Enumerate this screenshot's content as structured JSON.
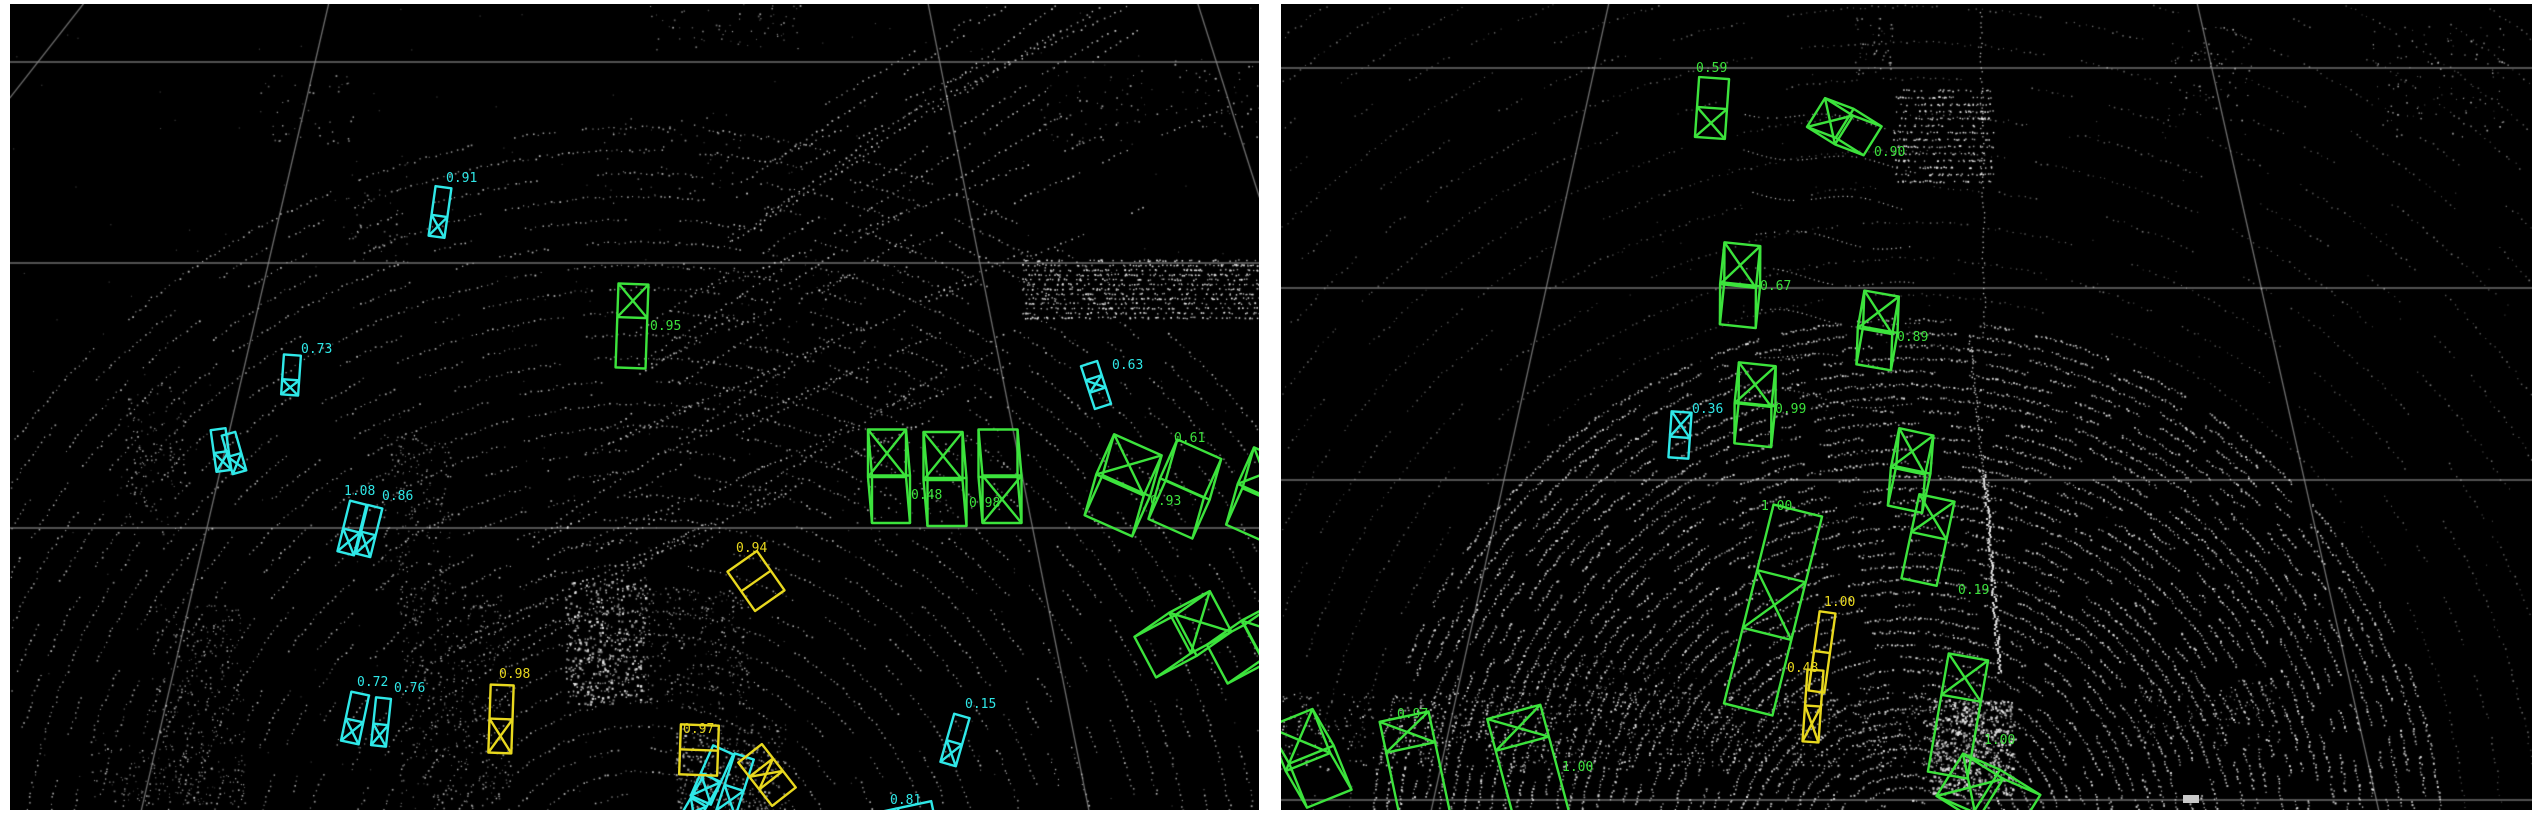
{
  "view": {
    "left_view_name": "lidar-bev-view-left",
    "right_view_name": "lidar-bev-view-right"
  },
  "colors": {
    "vehicle_green": "#3ce33c",
    "pedestrian_cyan": "#2fe8e8",
    "cyclist_yellow": "#e8d81e",
    "grid_line": "#8a8a8a",
    "point_cloud": "#efefef",
    "panel_background": "#000000",
    "page_background": "#ffffff",
    "ego_marker": "#c9c9c9"
  },
  "panels": [
    {
      "id": "left",
      "detections": [
        {
          "color": "cyan",
          "score": "0.91",
          "cx": 430,
          "cy": 208,
          "w": 16,
          "l": 50,
          "rot": 8,
          "shape": "box",
          "xmark": "bottom",
          "split": 0.42,
          "ldx": 6,
          "ldy": -30
        },
        {
          "color": "cyan",
          "score": "0.73",
          "cx": 281,
          "cy": 371,
          "w": 17,
          "l": 40,
          "rot": 4,
          "shape": "box",
          "xmark": "bottom",
          "split": 0.38,
          "ldx": 10,
          "ldy": -22
        },
        {
          "color": "cyan",
          "score": null,
          "cx": 211,
          "cy": 446,
          "w": 15,
          "l": 42,
          "rot": -8,
          "shape": "box",
          "xmark": "bottom",
          "split": 0.45,
          "ldx": 0,
          "ldy": 0
        },
        {
          "color": "cyan",
          "score": null,
          "cx": 224,
          "cy": 449,
          "w": 14,
          "l": 40,
          "rot": -16,
          "shape": "box",
          "xmark": "bottom",
          "split": 0.45,
          "ldx": 0,
          "ldy": 0
        },
        {
          "color": "cyan",
          "score": "1.08",
          "cx": 342,
          "cy": 524,
          "w": 17,
          "l": 52,
          "rot": 14,
          "shape": "box",
          "xmark": "bottom",
          "split": 0.45,
          "ldx": -8,
          "ldy": -33
        },
        {
          "color": "cyan",
          "score": "0.86",
          "cx": 359,
          "cy": 527,
          "w": 15,
          "l": 50,
          "rot": 14,
          "shape": "box",
          "xmark": "bottom",
          "split": 0.45,
          "ldx": 13,
          "ldy": -31
        },
        {
          "color": "cyan",
          "score": "0.72",
          "cx": 345,
          "cy": 714,
          "w": 18,
          "l": 50,
          "rot": 12,
          "shape": "box",
          "xmark": "bottom",
          "split": 0.45,
          "ldx": 2,
          "ldy": -32
        },
        {
          "color": "cyan",
          "score": "0.76",
          "cx": 371,
          "cy": 718,
          "w": 15,
          "l": 48,
          "rot": 6,
          "shape": "box",
          "xmark": "bottom",
          "split": 0.45,
          "ldx": 13,
          "ldy": -30
        },
        {
          "color": "cyan",
          "score": null,
          "cx": 702,
          "cy": 771,
          "w": 22,
          "l": 55,
          "rot": 24,
          "shape": "box",
          "xmark": "bottom",
          "split": 0.45,
          "ldx": 0,
          "ldy": 0
        },
        {
          "color": "cyan",
          "score": null,
          "cx": 725,
          "cy": 781,
          "w": 20,
          "l": 60,
          "rot": 18,
          "shape": "box",
          "xmark": "bottom",
          "split": 0.45,
          "ldx": 0,
          "ldy": 0
        },
        {
          "color": "cyan",
          "score": null,
          "cx": 690,
          "cy": 796,
          "w": 18,
          "l": 50,
          "rot": 30,
          "shape": "box",
          "xmark": "bottom",
          "split": 0.45,
          "ldx": 0,
          "ldy": 0
        },
        {
          "color": "cyan",
          "score": "0.15",
          "cx": 945,
          "cy": 736,
          "w": 16,
          "l": 50,
          "rot": 16,
          "shape": "box",
          "xmark": "bottom",
          "split": 0.45,
          "ldx": 10,
          "ldy": -32
        },
        {
          "color": "cyan",
          "score": "0.81",
          "cx": 890,
          "cy": 814,
          "w": 20,
          "l": 68,
          "rot": 78,
          "shape": "box",
          "xmark": "none",
          "split": 0.45,
          "ldx": -10,
          "ldy": -14
        },
        {
          "color": "cyan",
          "score": "0.63",
          "cx": 1086,
          "cy": 381,
          "w": 17,
          "l": 45,
          "rot": -18,
          "shape": "box",
          "xmark": "mid",
          "split": 0.45,
          "ldx": 16,
          "ldy": -16
        },
        {
          "color": "yellow",
          "score": "0.98",
          "cx": 491,
          "cy": 715,
          "w": 23,
          "l": 68,
          "rot": 2,
          "shape": "box",
          "xmark": "bottom",
          "split": 0.5,
          "ldx": -2,
          "ldy": -41
        },
        {
          "color": "yellow",
          "score": "0.97",
          "cx": 689,
          "cy": 746,
          "w": 38,
          "l": 50,
          "rot": 2,
          "shape": "box",
          "xmark": "none",
          "split": 0.45,
          "ldx": -16,
          "ldy": -17
        },
        {
          "color": "yellow",
          "score": null,
          "cx": 757,
          "cy": 771,
          "w": 30,
          "l": 55,
          "rot": -38,
          "shape": "box",
          "xmark": "mid",
          "split": 0.45,
          "ldx": 0,
          "ldy": 0
        },
        {
          "color": "yellow",
          "score": "0.94",
          "cx": 746,
          "cy": 577,
          "w": 36,
          "l": 48,
          "rot": -35,
          "shape": "box",
          "xmark": "none",
          "split": 0.5,
          "ldx": -20,
          "ldy": -29
        },
        {
          "color": "green",
          "score": "0.95",
          "cx": 622,
          "cy": 322,
          "w": 30,
          "l": 84,
          "rot": 2,
          "shape": "box",
          "xmark": "top",
          "split": 0.4,
          "ldx": 18,
          "ldy": 4
        },
        {
          "color": "green",
          "score": "0.48",
          "cx": 877,
          "cy": 473,
          "w": 38,
          "l": 95,
          "rot": 0,
          "shape": "cuboid",
          "ex": 4,
          "ey": 46,
          "xmark": "top",
          "split": 0.45,
          "ldx": 24,
          "ldy": 22
        },
        {
          "color": "green",
          "score": "0.98",
          "cx": 933,
          "cy": 476,
          "w": 39,
          "l": 96,
          "rot": 0,
          "shape": "cuboid",
          "ex": 4,
          "ey": 46,
          "xmark": "top",
          "split": 0.45,
          "ldx": 26,
          "ldy": 27
        },
        {
          "color": "green",
          "score": null,
          "cx": 988,
          "cy": 473,
          "w": 39,
          "l": 95,
          "rot": 0,
          "shape": "cuboid",
          "ex": 4,
          "ey": 46,
          "xmark": "bottom",
          "split": 0.45,
          "ldx": 0,
          "ldy": 0
        },
        {
          "color": "green",
          "score": "0.93",
          "cx": 1110,
          "cy": 481,
          "w": 52,
          "l": 88,
          "rot": 24,
          "shape": "cuboid",
          "ex": 6,
          "ey": 42,
          "xmark": "top",
          "split": 0.45,
          "ldx": 30,
          "ldy": 20
        },
        {
          "color": "green",
          "score": "0.61",
          "cx": 1172,
          "cy": 484,
          "w": 48,
          "l": 85,
          "rot": 24,
          "shape": "cuboid",
          "ex": 6,
          "ey": 42,
          "xmark": "none",
          "split": 0.45,
          "ldx": -8,
          "ldy": -46
        },
        {
          "color": "green",
          "score": null,
          "cx": 1246,
          "cy": 488,
          "w": 40,
          "l": 80,
          "rot": 24,
          "shape": "cuboid",
          "ex": 6,
          "ey": 42,
          "xmark": "top",
          "split": 0.45,
          "ldx": 0,
          "ldy": 0
        },
        {
          "color": "green",
          "score": null,
          "cx": 1170,
          "cy": 629,
          "w": 46,
          "l": 92,
          "rot": 62,
          "shape": "cuboid",
          "ex": 5,
          "ey": 42,
          "xmark": "top",
          "split": 0.45,
          "ldx": 0,
          "ldy": 0
        },
        {
          "color": "green",
          "score": null,
          "cx": 1242,
          "cy": 636,
          "w": 44,
          "l": 85,
          "rot": 62,
          "shape": "cuboid",
          "ex": 5,
          "ey": 42,
          "xmark": "top",
          "split": 0.45,
          "ldx": 0,
          "ldy": 0
        }
      ]
    },
    {
      "id": "right",
      "ego_marker": true,
      "detections": [
        {
          "color": "green",
          "score": "0.59",
          "cx": 431,
          "cy": 104,
          "w": 30,
          "l": 60,
          "rot": 4,
          "shape": "box",
          "xmark": "bottom",
          "split": 0.5,
          "ldx": -16,
          "ldy": -36
        },
        {
          "color": "green",
          "score": "0.90",
          "cx": 563,
          "cy": 126,
          "w": 34,
          "l": 66,
          "rot": -58,
          "shape": "cuboid",
          "ex": 6,
          "ey": 30,
          "xmark": "top",
          "split": 0.45,
          "ldx": 30,
          "ldy": 26
        },
        {
          "color": "green",
          "score": "0.67",
          "cx": 457,
          "cy": 282,
          "w": 36,
          "l": 84,
          "rot": 6,
          "shape": "cuboid",
          "ex": 4,
          "ey": 40,
          "xmark": "top",
          "split": 0.45,
          "ldx": 22,
          "ldy": 4
        },
        {
          "color": "green",
          "score": "0.89",
          "cx": 594,
          "cy": 327,
          "w": 35,
          "l": 76,
          "rot": 10,
          "shape": "cuboid",
          "ex": 5,
          "ey": 36,
          "xmark": "top",
          "split": 0.45,
          "ldx": 22,
          "ldy": 10
        },
        {
          "color": "green",
          "score": "0.99",
          "cx": 472,
          "cy": 401,
          "w": 37,
          "l": 82,
          "rot": 6,
          "shape": "cuboid",
          "ex": 4,
          "ey": 40,
          "xmark": "top",
          "split": 0.45,
          "ldx": 22,
          "ldy": 8
        },
        {
          "color": "green",
          "score": null,
          "cx": 627,
          "cy": 467,
          "w": 35,
          "l": 80,
          "rot": 12,
          "shape": "cuboid",
          "ex": 5,
          "ey": 38,
          "xmark": "top",
          "split": 0.45,
          "ldx": 0,
          "ldy": 0
        },
        {
          "color": "cyan",
          "score": "0.36",
          "cx": 399,
          "cy": 431,
          "w": 20,
          "l": 46,
          "rot": 4,
          "shape": "box",
          "xmark": "top",
          "split": 0.55,
          "ldx": 12,
          "ldy": -22
        },
        {
          "color": "green",
          "score": "1.00",
          "cx": 492,
          "cy": 606,
          "w": 50,
          "l": 205,
          "rot": 14,
          "shape": "box",
          "xmark": "mid",
          "split": 0.45,
          "ldx": -12,
          "ldy": -100
        },
        {
          "color": "yellow",
          "score": "1.00",
          "cx": 541,
          "cy": 648,
          "w": 16,
          "l": 80,
          "rot": 8,
          "shape": "box",
          "xmark": "none",
          "split": 0.5,
          "ldx": 2,
          "ldy": -46
        },
        {
          "color": "yellow",
          "score": "0.48",
          "cx": 532,
          "cy": 702,
          "w": 16,
          "l": 72,
          "rot": 4,
          "shape": "box",
          "xmark": "bottom",
          "split": 0.5,
          "ldx": -26,
          "ldy": -34
        },
        {
          "color": "green",
          "score": "0.19",
          "cx": 647,
          "cy": 536,
          "w": 36,
          "l": 86,
          "rot": 12,
          "shape": "box",
          "xmark": "top",
          "split": 0.45,
          "ldx": 30,
          "ldy": 54
        },
        {
          "color": "green",
          "score": "1.00",
          "cx": 677,
          "cy": 712,
          "w": 40,
          "l": 120,
          "rot": 10,
          "shape": "box",
          "xmark": "top",
          "split": 0.35,
          "ldx": 26,
          "ldy": 28
        },
        {
          "color": "green",
          "score": null,
          "cx": 709,
          "cy": 796,
          "w": 50,
          "l": 95,
          "rot": -58,
          "shape": "cuboid",
          "ex": 6,
          "ey": 40,
          "xmark": "top",
          "split": 0.45,
          "ldx": 0,
          "ldy": 0
        },
        {
          "color": "green",
          "score": null,
          "cx": 27,
          "cy": 758,
          "w": 48,
          "l": 95,
          "rot": -22,
          "shape": "cuboid",
          "ex": 6,
          "ey": 42,
          "xmark": "top",
          "split": 0.45,
          "ldx": 0,
          "ldy": 0
        },
        {
          "color": "green",
          "score": "0.97",
          "cx": 134,
          "cy": 764,
          "w": 50,
          "l": 105,
          "rot": -12,
          "shape": "box",
          "xmark": "top",
          "split": 0.3,
          "ldx": -18,
          "ldy": -50
        },
        {
          "color": "green",
          "score": "1.00",
          "cx": 247,
          "cy": 761,
          "w": 55,
          "l": 110,
          "rot": -15,
          "shape": "box",
          "xmark": "top",
          "split": 0.3,
          "ldx": 34,
          "ldy": 6
        }
      ]
    }
  ]
}
